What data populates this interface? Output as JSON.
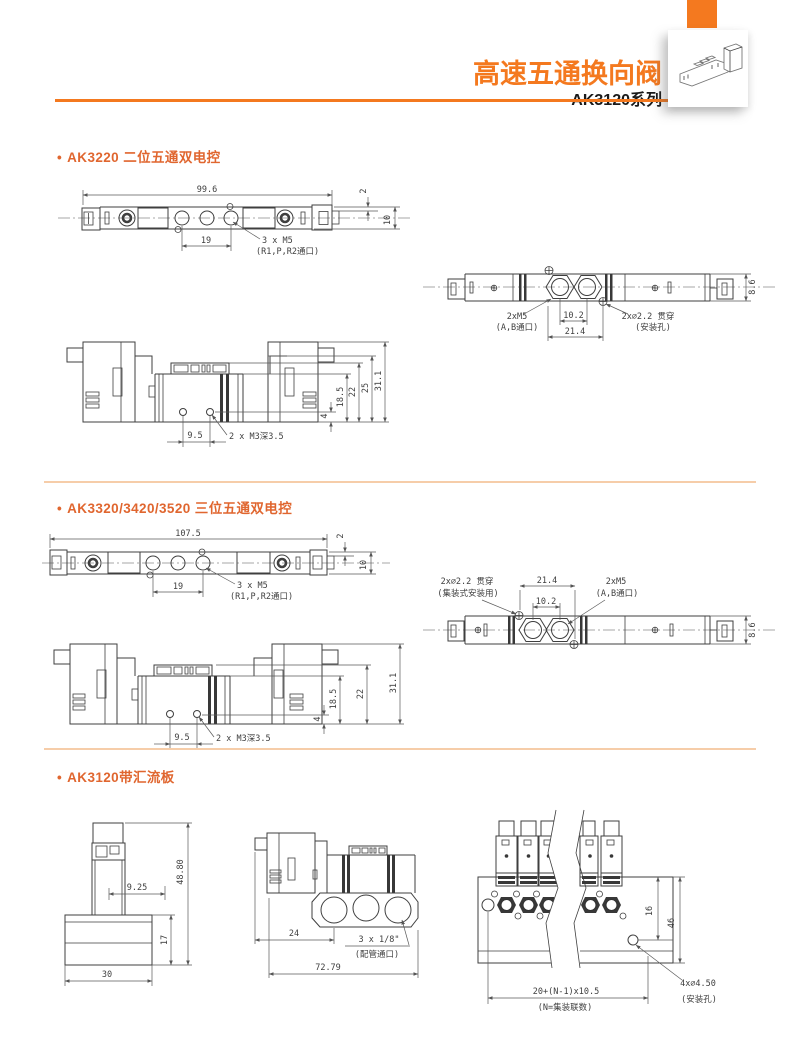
{
  "header": {
    "title": "高速五通换向阀",
    "series": "AK3120系列"
  },
  "colors": {
    "accent": "#F4791F",
    "heading": "#E0662F",
    "divider": "#F6CDA9"
  },
  "sections": {
    "s1": {
      "bullet": "•",
      "heading": "AK3220 二位五通双电控",
      "side": {
        "overall": "99.6",
        "spacing": "19",
        "note": "3 x M5",
        "note_sub": "(R1,P,R2通口)",
        "edge": "2",
        "height": "10"
      },
      "top": {
        "ports": "2xM5",
        "ports_sub": "(A,B通口)",
        "holes": "2x∅2.2 贯穿",
        "holes_sub": "(安装孔)",
        "inner": "10.2",
        "outer": "21.4",
        "height": "8.6"
      },
      "front": {
        "d1": "18.5",
        "d2": "22",
        "d3": "25",
        "d4": "31.1",
        "base": "4",
        "spacing": "9.5",
        "note": "2 x M3深3.5"
      }
    },
    "s2": {
      "bullet": "•",
      "heading": "AK3320/3420/3520 三位五通双电控",
      "side": {
        "overall": "107.5",
        "spacing": "19",
        "note": "3 x M5",
        "note_sub": "(R1,P,R2通口)",
        "edge": "2",
        "height": "10"
      },
      "top": {
        "holes": "2x∅2.2 贯穿",
        "holes_sub": "(集装式安装用)",
        "ports": "2xM5",
        "ports_sub": "(A,B通口)",
        "inner": "10.2",
        "outer": "21.4",
        "height": "8.6"
      },
      "front": {
        "d1": "18.5",
        "d2": "22",
        "d4": "31.1",
        "base": "4",
        "spacing": "9.5",
        "note": "2 x M3深3.5"
      }
    },
    "s3": {
      "bullet": "•",
      "heading": "AK3120带汇流板",
      "end": {
        "height": "48.80",
        "offset": "9.25",
        "base_h": "17",
        "base_w": "30"
      },
      "side": {
        "offset": "24",
        "note": "3 x 1/8\"",
        "note_sub": "(配管通口)",
        "overall": "72.79"
      },
      "top": {
        "d16": "16",
        "d46": "46",
        "pitch": "20+(N-1)x10.5",
        "pitch_sub": "(N=集装联数)",
        "holes": "4x∅4.50",
        "holes_sub": "(安装孔)"
      }
    }
  }
}
